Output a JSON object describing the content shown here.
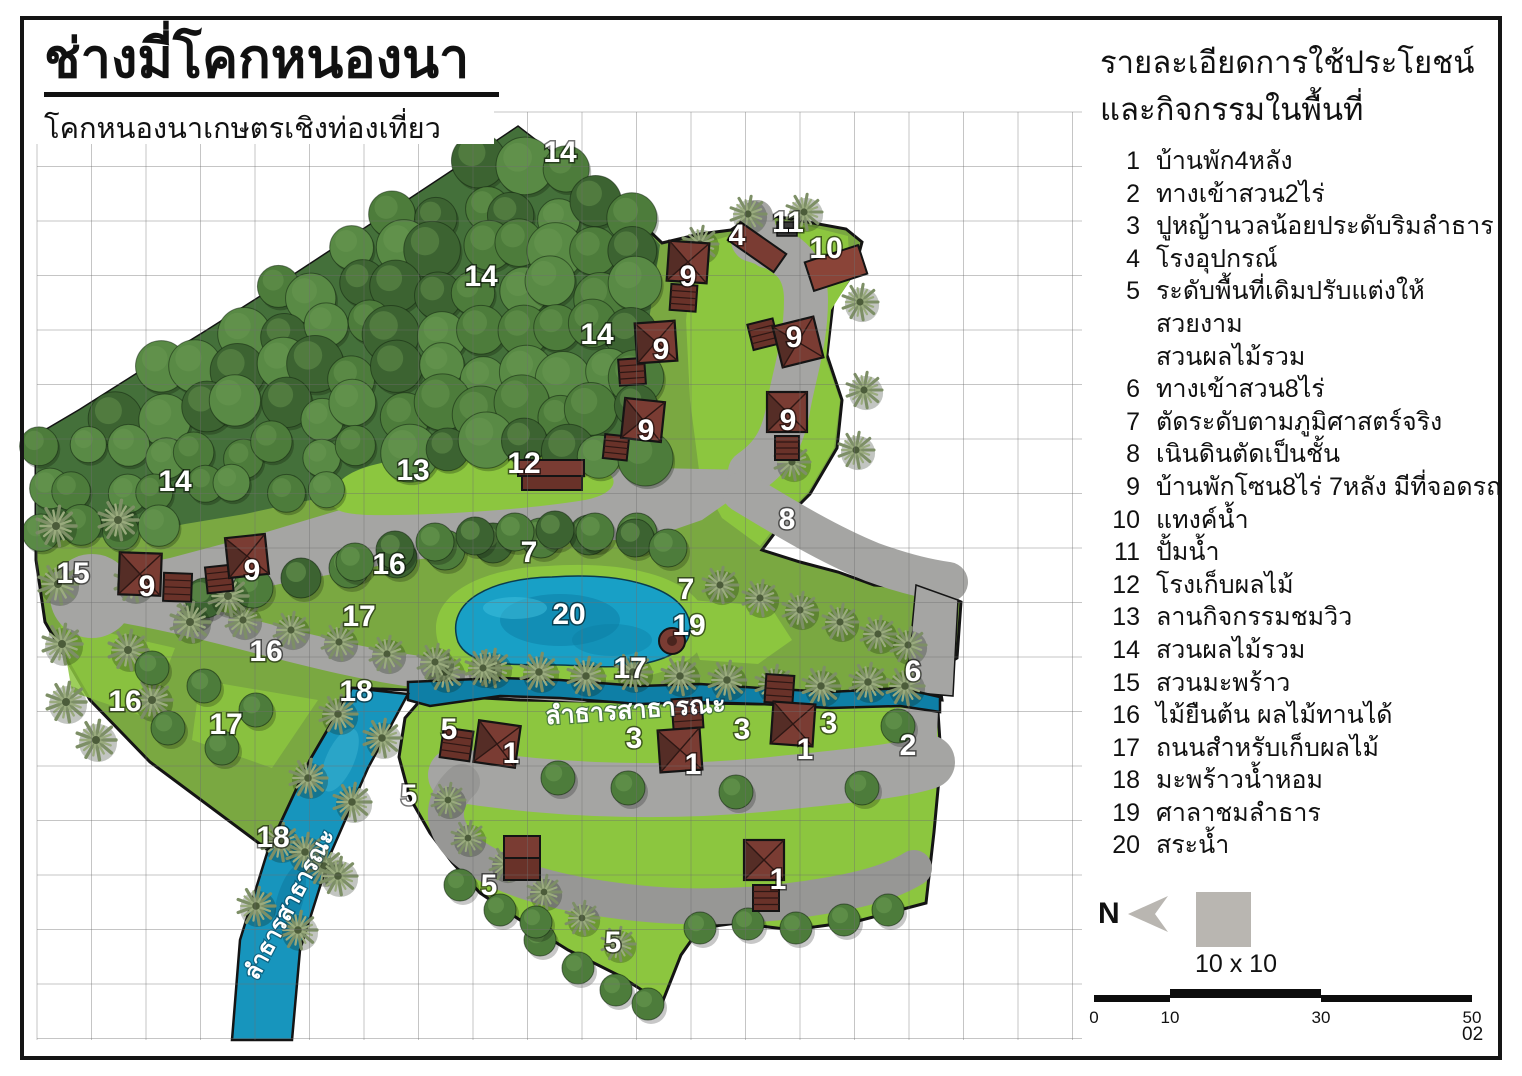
{
  "title": {
    "main": "ช่างมี่โคกหนองนา",
    "subtitle": "โคกหนองนาเกษตรเชิงท่องเที่ยว"
  },
  "legend": {
    "heading_line1": "รายละเอียดการใช้ประโยชน์",
    "heading_line2": "และกิจกรรมในพื้นที่",
    "items": [
      {
        "no": "1",
        "text": "บ้านพัก4หลัง"
      },
      {
        "no": "2",
        "text": "ทางเข้าสวน2ไร่"
      },
      {
        "no": "3",
        "text": "ปูหญ้านวลน้อยประดับริมลำธาร"
      },
      {
        "no": "4",
        "text": "โรงอุปกรณ์"
      },
      {
        "no": "5",
        "text": "ระดับพื้นที่เดิมปรับแต่งให้สวยงาม",
        "text2": "สวนผลไม้รวม"
      },
      {
        "no": "6",
        "text": "ทางเข้าสวน8ไร่"
      },
      {
        "no": "7",
        "text": "ตัดระดับตามภูมิศาสตร์จริง"
      },
      {
        "no": "8",
        "text": "เนินดินตัดเป็นชั้น"
      },
      {
        "no": "9",
        "text": "บ้านพักโซน8ไร่ 7หลัง มีที่จอดรถ"
      },
      {
        "no": "10",
        "text": "แทงค์น้ำ"
      },
      {
        "no": "11",
        "text": "ปั้มน้ำ"
      },
      {
        "no": "12",
        "text": "โรงเก็บผลไม้"
      },
      {
        "no": "13",
        "text": "ลานกิจกรรมชมวิว"
      },
      {
        "no": "14",
        "text": "สวนผลไม้รวม"
      },
      {
        "no": "15",
        "text": "สวนมะพร้าว"
      },
      {
        "no": "16",
        "text": "ไม้ยืนต้น ผลไม้ทานได้"
      },
      {
        "no": "17",
        "text": "ถนนสำหรับเก็บผลไม้"
      },
      {
        "no": "18",
        "text": "มะพร้าวน้ำหอม"
      },
      {
        "no": "19",
        "text": "ศาลาชมลำธาร"
      },
      {
        "no": "20",
        "text": "สระน้ำ"
      }
    ]
  },
  "map": {
    "labels": [
      {
        "n": "14",
        "x": 560,
        "y": 162
      },
      {
        "n": "14",
        "x": 481,
        "y": 286
      },
      {
        "n": "14",
        "x": 597,
        "y": 344
      },
      {
        "n": "14",
        "x": 175,
        "y": 491
      },
      {
        "n": "4",
        "x": 737,
        "y": 245
      },
      {
        "n": "11",
        "x": 788,
        "y": 232
      },
      {
        "n": "10",
        "x": 826,
        "y": 258
      },
      {
        "n": "9",
        "x": 688,
        "y": 286
      },
      {
        "n": "9",
        "x": 661,
        "y": 359
      },
      {
        "n": "9",
        "x": 794,
        "y": 347
      },
      {
        "n": "9",
        "x": 646,
        "y": 440
      },
      {
        "n": "9",
        "x": 788,
        "y": 430
      },
      {
        "n": "9",
        "x": 252,
        "y": 580
      },
      {
        "n": "9",
        "x": 147,
        "y": 596
      },
      {
        "n": "12",
        "x": 524,
        "y": 473
      },
      {
        "n": "13",
        "x": 413,
        "y": 480
      },
      {
        "n": "8",
        "x": 787,
        "y": 529
      },
      {
        "n": "15",
        "x": 73,
        "y": 583
      },
      {
        "n": "16",
        "x": 389,
        "y": 574
      },
      {
        "n": "16",
        "x": 266,
        "y": 661
      },
      {
        "n": "16",
        "x": 125,
        "y": 711
      },
      {
        "n": "17",
        "x": 359,
        "y": 626
      },
      {
        "n": "17",
        "x": 630,
        "y": 678
      },
      {
        "n": "17",
        "x": 226,
        "y": 734
      },
      {
        "n": "18",
        "x": 356,
        "y": 701
      },
      {
        "n": "18",
        "x": 273,
        "y": 847
      },
      {
        "n": "20",
        "x": 569,
        "y": 624
      },
      {
        "n": "19",
        "x": 689,
        "y": 635
      },
      {
        "n": "7",
        "x": 529,
        "y": 562
      },
      {
        "n": "7",
        "x": 686,
        "y": 599
      },
      {
        "n": "6",
        "x": 913,
        "y": 681
      },
      {
        "n": "5",
        "x": 449,
        "y": 739
      },
      {
        "n": "5",
        "x": 409,
        "y": 805
      },
      {
        "n": "5",
        "x": 489,
        "y": 895
      },
      {
        "n": "5",
        "x": 613,
        "y": 952
      },
      {
        "n": "3",
        "x": 634,
        "y": 748
      },
      {
        "n": "3",
        "x": 742,
        "y": 739
      },
      {
        "n": "3",
        "x": 829,
        "y": 733
      },
      {
        "n": "1",
        "x": 511,
        "y": 763
      },
      {
        "n": "1",
        "x": 693,
        "y": 774
      },
      {
        "n": "1",
        "x": 805,
        "y": 759
      },
      {
        "n": "1",
        "x": 778,
        "y": 889
      },
      {
        "n": "2",
        "x": 908,
        "y": 755
      }
    ],
    "stream_labels": [
      {
        "text": "ลำธารสาธารณะ",
        "x": 636,
        "y": 718,
        "rotate": -4,
        "size": 25
      },
      {
        "text": "ลำธารสาธารณะ",
        "x": 296,
        "y": 908,
        "rotate": -62,
        "size": 23
      }
    ]
  },
  "compass": {
    "label": "N"
  },
  "grid_legend": {
    "label": "10 x 10"
  },
  "scalebar": {
    "ticks": [
      "0",
      "10",
      "30",
      "50"
    ]
  },
  "page": {
    "number": "02"
  },
  "colors": {
    "forest_fill": "#44703a",
    "canopy_dark": "#3c6331",
    "canopy_mid": "#4d7c3b",
    "canopy_light": "#598a45",
    "lawn_green": "#8cc63f",
    "base_green": "#7aa841",
    "road_gray": "#a5a5a3",
    "road_gray_dark": "#979795",
    "pond_blue": "#18a0c6",
    "pond_deep": "#0c7ca3",
    "canal_blue": "#0e7fa6",
    "river_blue": "#1795bd",
    "building_red": "#7a3c33",
    "building_red_dark": "#693229",
    "roof_line": "#2e1714",
    "outline": "#141414",
    "grid": "#6f6f6f",
    "scale_gray": "#b9b6b1",
    "palm_frond": "#7d8f66",
    "palm_frond_light": "#9aab7e",
    "palm_center": "#4c5c3a"
  }
}
